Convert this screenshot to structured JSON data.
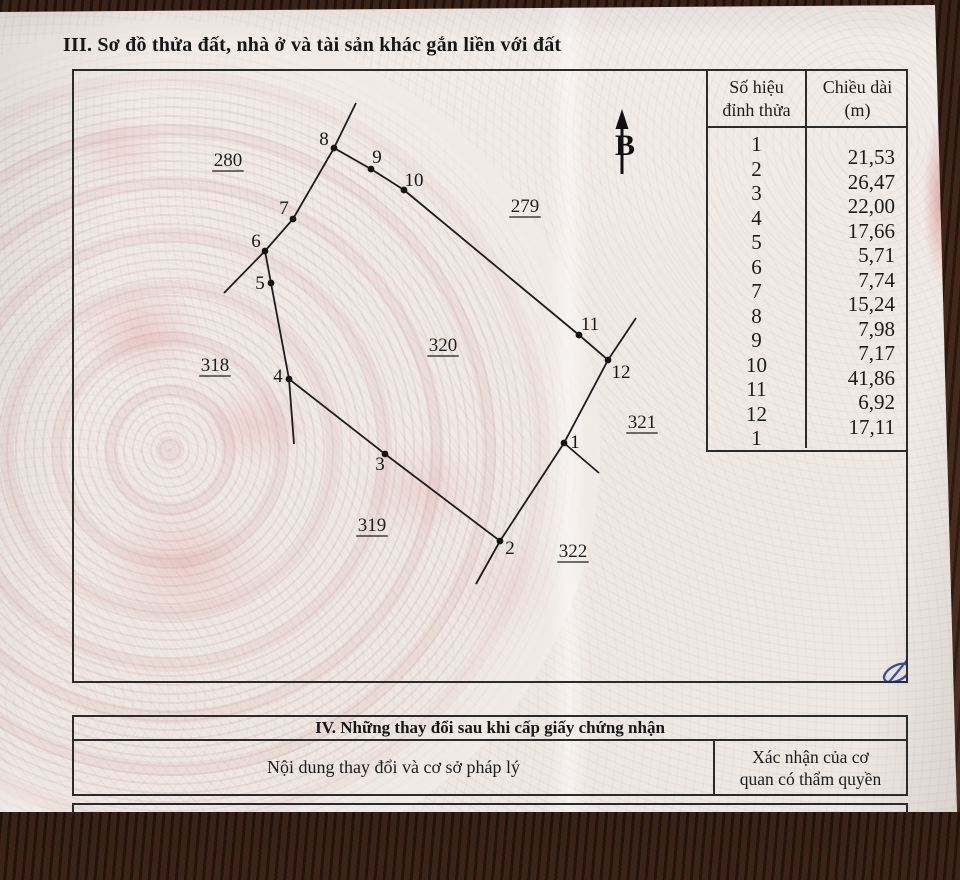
{
  "title_section3": "III. Sơ đồ thửa đất, nhà ở và tài sản khác gắn liền với đất",
  "vertex_table": {
    "header_col1_line1": "Số hiệu",
    "header_col1_line2": "đỉnh thửa",
    "header_col2_line1": "Chiều dài",
    "header_col2_line2": "(m)",
    "vertex_ids": [
      "1",
      "2",
      "3",
      "4",
      "5",
      "6",
      "7",
      "8",
      "9",
      "10",
      "11",
      "12",
      "1"
    ],
    "lengths_m": [
      "21,53",
      "26,47",
      "22,00",
      "17,66",
      "5,71",
      "7,74",
      "15,24",
      "7,98",
      "7,17",
      "41,86",
      "6,92",
      "17,11"
    ]
  },
  "diagram": {
    "vertices": [
      {
        "id": "1",
        "x": 490,
        "y": 372,
        "lx": 501,
        "ly": 371
      },
      {
        "id": "2",
        "x": 426,
        "y": 470,
        "lx": 436,
        "ly": 477
      },
      {
        "id": "3",
        "x": 311,
        "y": 383,
        "lx": 306,
        "ly": 393
      },
      {
        "id": "4",
        "x": 215,
        "y": 308,
        "lx": 204,
        "ly": 305
      },
      {
        "id": "5",
        "x": 197,
        "y": 212,
        "lx": 186,
        "ly": 212
      },
      {
        "id": "6",
        "x": 191,
        "y": 180,
        "lx": 182,
        "ly": 170
      },
      {
        "id": "7",
        "x": 219,
        "y": 148,
        "lx": 210,
        "ly": 137
      },
      {
        "id": "8",
        "x": 260,
        "y": 77,
        "lx": 250,
        "ly": 68
      },
      {
        "id": "9",
        "x": 297,
        "y": 98,
        "lx": 303,
        "ly": 86
      },
      {
        "id": "10",
        "x": 330,
        "y": 119,
        "lx": 340,
        "ly": 109
      },
      {
        "id": "11",
        "x": 505,
        "y": 264,
        "lx": 516,
        "ly": 253
      },
      {
        "id": "12",
        "x": 534,
        "y": 289,
        "lx": 547,
        "ly": 301
      }
    ],
    "extension_lines": [
      [
        260,
        77,
        282,
        32
      ],
      [
        191,
        180,
        150,
        222
      ],
      [
        215,
        308,
        220,
        373
      ],
      [
        426,
        470,
        402,
        513
      ],
      [
        490,
        372,
        525,
        402
      ],
      [
        534,
        289,
        562,
        247
      ]
    ],
    "parcel_labels": [
      {
        "text": "280",
        "x": 154,
        "y": 88
      },
      {
        "text": "279",
        "x": 451,
        "y": 134
      },
      {
        "text": "318",
        "x": 141,
        "y": 293
      },
      {
        "text": "320",
        "x": 369,
        "y": 273
      },
      {
        "text": "321",
        "x": 568,
        "y": 350
      },
      {
        "text": "319",
        "x": 298,
        "y": 453
      },
      {
        "text": "322",
        "x": 499,
        "y": 479
      }
    ],
    "north_arrow": {
      "x": 548,
      "tip_y": 38,
      "head_base_y": 58,
      "line_bottom_y": 103,
      "label": "B",
      "label_x": 551,
      "label_baseline_y": 84
    },
    "signature": {
      "x": 823,
      "y": 602,
      "color": "#31519f"
    }
  },
  "section4": {
    "title": "IV. Những thay đổi sau khi cấp giấy chứng nhận",
    "col1_header": "Nội dung thay đổi và cơ sở pháp lý",
    "col2_header_line1": "Xác nhận của cơ",
    "col2_header_line2": "quan có thẩm quyền"
  }
}
